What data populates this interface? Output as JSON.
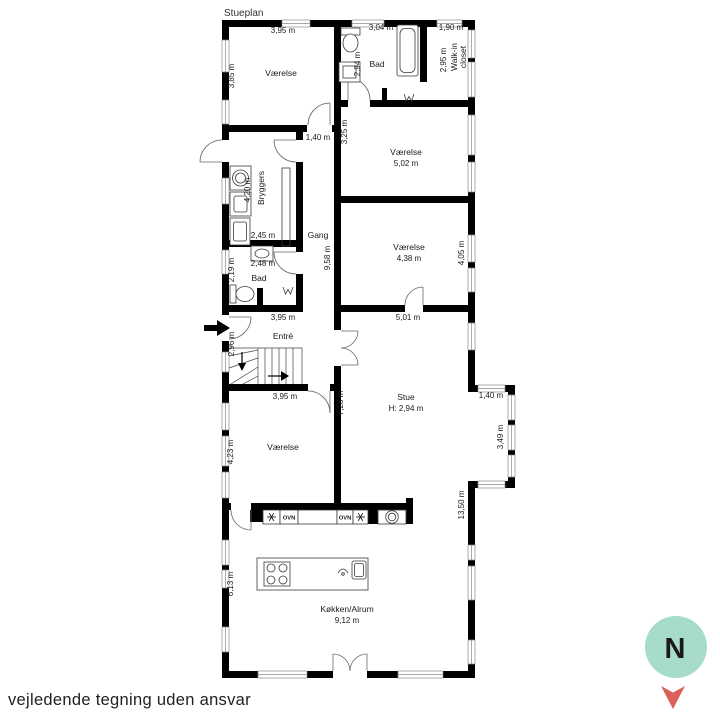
{
  "title": "Stueplan",
  "disclaimer": "vejledende tegning uden ansvar",
  "compass": {
    "letter": "N"
  },
  "colors": {
    "wall": "#000000",
    "compass_circle": "#a6dcc9",
    "compass_letter": "#186258",
    "compass_arrow": "#d9615a"
  },
  "rooms": {
    "vaerelse_nw": {
      "name": "Værelse",
      "width": "3,95 m",
      "height": "3,85 m"
    },
    "bad_n": {
      "name": "Bad",
      "width": "3,04 m",
      "height": "2,94 m"
    },
    "walkin": {
      "line1": "Walk-in",
      "line2": "closet",
      "width": "1,90 m",
      "depth": "2,95 m"
    },
    "hall_door": {
      "width": "1,40 m"
    },
    "vaerelse_n": {
      "name": "Værelse",
      "size": "5,02 m",
      "wall": "3,25 m"
    },
    "bryggers": {
      "name": "Bryggers",
      "length": "4,20 m",
      "width": "2,45 m"
    },
    "gang": {
      "name": "Gang",
      "length": "9,58 m"
    },
    "bad_w": {
      "name": "Bad",
      "width": "2,48 m",
      "depth": "2,19 m",
      "south": "3,95 m"
    },
    "vaerelse_e": {
      "name": "Værelse",
      "size": "4,38 m",
      "east": "4,05 m",
      "south": "5,01 m"
    },
    "entre": {
      "name": "Entré",
      "height": "2,96 m"
    },
    "stairs": {
      "width": "3,95 m"
    },
    "vaerelse_sw": {
      "name": "Værelse",
      "height": "4,23 m"
    },
    "stue": {
      "name": "Stue",
      "ceiling": "H: 2,94 m",
      "west": "7,28 m",
      "bay_width": "1,40 m",
      "bay_depth": "3,49 m"
    },
    "koekken": {
      "name": "Køkken/Alrum",
      "size": "9,12 m",
      "west": "6,13 m",
      "east": "13,50 m"
    },
    "appliances": {
      "oven": "OVN"
    }
  }
}
